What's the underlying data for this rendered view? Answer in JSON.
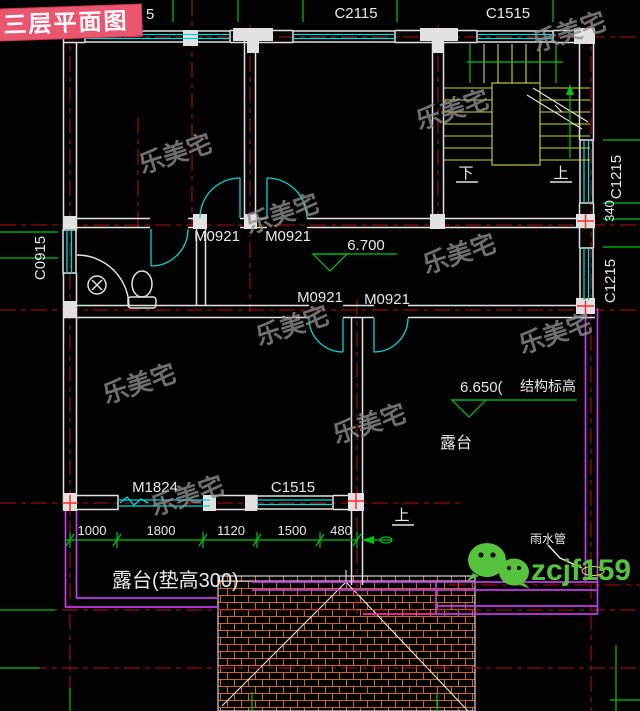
{
  "banner": {
    "title": "三层平面图"
  },
  "watermark": {
    "text": "乐美宅"
  },
  "wechat": {
    "id": "zcjf159"
  },
  "labels": {
    "window_top_partial": "5",
    "c2115": "C2115",
    "c1515_top": "C1515",
    "c1215_upper": "C1215",
    "dim_340": "340",
    "c1215_lower": "C1215",
    "c0915": "C0915",
    "m0921_a": "M0921",
    "m0921_b": "M0921",
    "m0921_c": "M0921",
    "m0921_d": "M0921",
    "elev_hall": "6.700",
    "elev_terrace": "6.650(",
    "elev_terrace_note": "结构标高",
    "terrace": "露台",
    "terrace_note": "露台(垫高300)",
    "m1824": "M1824",
    "c1515_bottom": "C1515",
    "rain_pipe": "雨水管",
    "stair_down": "下",
    "stair_up": "上",
    "stair_up2": "上"
  },
  "dimensions": {
    "values": [
      "1000",
      "1800",
      "1120",
      "1500",
      "480"
    ]
  },
  "colors": {
    "background": "#020202",
    "grid_red": "#b01010",
    "wall_white": "#e2e2e2",
    "window_cyan": "#00d8d8",
    "stair_yellow": "#d6d637",
    "dim_green": "#00c414",
    "roof_orange": "#c76a1a",
    "parapet_purple": "#c03ce8",
    "banner_pink": "#ea5570",
    "wechat_green": "#57c23d",
    "watermark_gray": "#8e8e8e"
  }
}
